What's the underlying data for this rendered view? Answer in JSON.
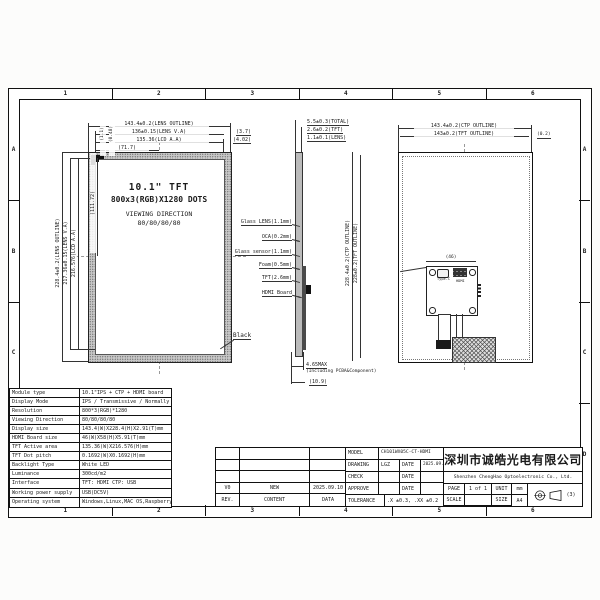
{
  "colors": {
    "line": "#1a1a1a",
    "paper": "#ffffff",
    "bezel": "#c6c6c6"
  },
  "frame": {
    "cols": [
      "1",
      "2",
      "3",
      "4",
      "5",
      "6"
    ],
    "rows": [
      "A",
      "B",
      "C",
      "D"
    ]
  },
  "front_view": {
    "label_line1": "10.1\" TFT",
    "label_line2": "800x3(RGB)X1280 DOTS",
    "label_line3": "VIEWING DIRECTION",
    "label_line4": "80/80/80/80",
    "callout_black": "Black",
    "dim_top_1": "143.4±0.2(LENS OUTLINE)",
    "dim_top_2": "136±0.15(LENS V.A)",
    "dim_top_3": "135.36(LCD A.A)",
    "dim_top_4": "(71.7)",
    "dim_top_right_1": "(3.7)",
    "dim_top_right_2": "(4.02)",
    "dim_left_1": "228.4±0.2(LENS OUTLINE)",
    "dim_left_2": "217.36±0.15(LENS V.A)",
    "dim_left_3": "216.576(LCD A.A)",
    "dim_left_4": "(111.72)",
    "dim_corner_1": "(1.1)",
    "dim_corner_2": "(0.48)"
  },
  "side_view": {
    "dim_total": "5.5±0.3(TOTAL)",
    "dim_tft": "2.6±0.2(TFT)",
    "dim_lens": "1.1±0.1(LENS)",
    "stack": [
      "Glass LENS(1.1mm)",
      "OCA(0.2mm)",
      "Glass sensor(1.1mm)",
      "Foam(0.5mm)",
      "TFT(2.6mm)",
      "HDMI Board"
    ],
    "dim_bottom_max": "4.65MAX",
    "dim_bottom_note": "(Including PCBA&Component)",
    "dim_bottom_width": "(10.9)"
  },
  "rear_view": {
    "dim_top_1": "143.4±0.2(CTP OUTLINE)",
    "dim_top_2": "143±0.2(TFT OUTLINE)",
    "dim_top_right": "(0.2)",
    "dim_left_1": "228.4±0.2(CTP OUTLINE)",
    "dim_left_2": "228±0.2(TFT OUTLINE)",
    "board_dim": "(46)",
    "connector_1": "Type-C",
    "connector_2": "HDMI"
  },
  "spec_table": {
    "rows": [
      {
        "label": "Module type",
        "value": "10.1\"IPS + CTP + HDMI board"
      },
      {
        "label": "Display Mode",
        "value": "IPS / Transmissive / Normally black"
      },
      {
        "label": "Resolution",
        "value": "800*3(RGB)*1280"
      },
      {
        "label": "Viewing Direction",
        "value": "80/80/80/80"
      },
      {
        "label": "Display size",
        "value": "143.4(W)X228.4(H)X2.91(T)mm"
      },
      {
        "label": "HDMI Board size",
        "value": "46(W)X58(H)X5.91(T)mm"
      },
      {
        "label": "TFT Active area",
        "value": "135.36(W)X216.576(H)mm"
      },
      {
        "label": "TFT Dot pitch",
        "value": "0.1692(W)X0.1692(H)mm"
      },
      {
        "label": "Backlight Type",
        "value": "White LED"
      },
      {
        "label": "Luminance",
        "value": "300cd/m2"
      },
      {
        "label": "Interface",
        "value": "TFT: HDMI   CTP: USB"
      },
      {
        "label": "Working power supply",
        "value": "USB(DC5V)"
      },
      {
        "label": "Operating system",
        "value": "Windows,Linux,MAC OS,Raspberry Pi,etc"
      }
    ]
  },
  "revision_block": {
    "rows": [
      {
        "rev": "",
        "content": "",
        "date": ""
      },
      {
        "rev": "",
        "content": "",
        "date": ""
      },
      {
        "rev": "",
        "content": "",
        "date": ""
      },
      {
        "rev": "V0",
        "content": "NEW",
        "date": "2025.09.10"
      },
      {
        "rev": "REV.",
        "content": "CONTENT",
        "date": "DATA"
      }
    ]
  },
  "title_block": {
    "model_label": "MODEL",
    "model": "CH101WX05C-CT-HDMI",
    "drawing_label": "DRAWING",
    "drawing": "LGZ",
    "date_label": "DATE",
    "drawing_date": "2025.09.10",
    "check_label": "CHECK",
    "approve_label": "APPROVE",
    "tolerance_label": "TOLERANCE",
    "tolerance": ".X ±0.3, .XX ±0.2",
    "company_cn": "深圳市诚皓光电有限公司",
    "company_en": "Shenzhen ChengHao Optoelectronic Co., Ltd.",
    "page_label": "PAGE",
    "page": "1 of 1",
    "unit_label": "UNIT",
    "unit": "mm",
    "scale_label": "SCALE",
    "scale": "",
    "size_label": "SIZE",
    "size": "A4",
    "projection_note": "(3)"
  }
}
